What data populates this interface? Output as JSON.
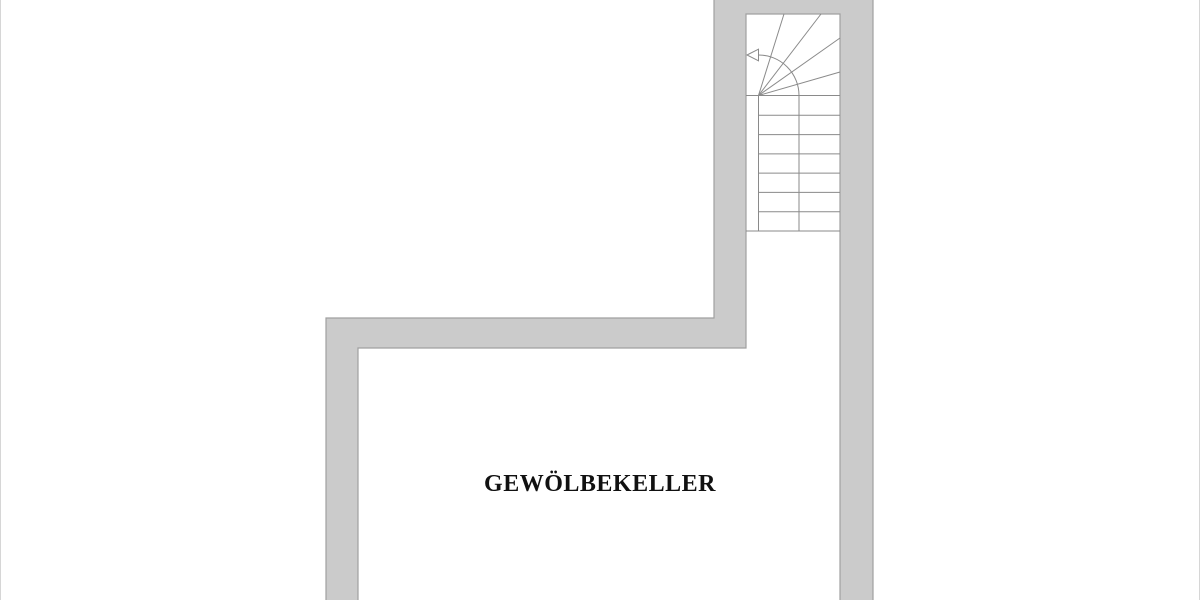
{
  "floor_plan": {
    "room_label": "GEWÖLBEKELLER",
    "stairs": {
      "straight_step_count": 7,
      "winder_step_count": 5,
      "walk_direction_icon": "arrow-left-icon"
    }
  },
  "colors": {
    "background": "#ffffff",
    "page_edge_border": "#d6d6d6",
    "wall_fill": "#cbcbcb",
    "wall_outline": "#a0a0a0",
    "stair_line": "#8a8a8a",
    "arrow_fill": "#ffffff",
    "label_text": "#111111"
  }
}
